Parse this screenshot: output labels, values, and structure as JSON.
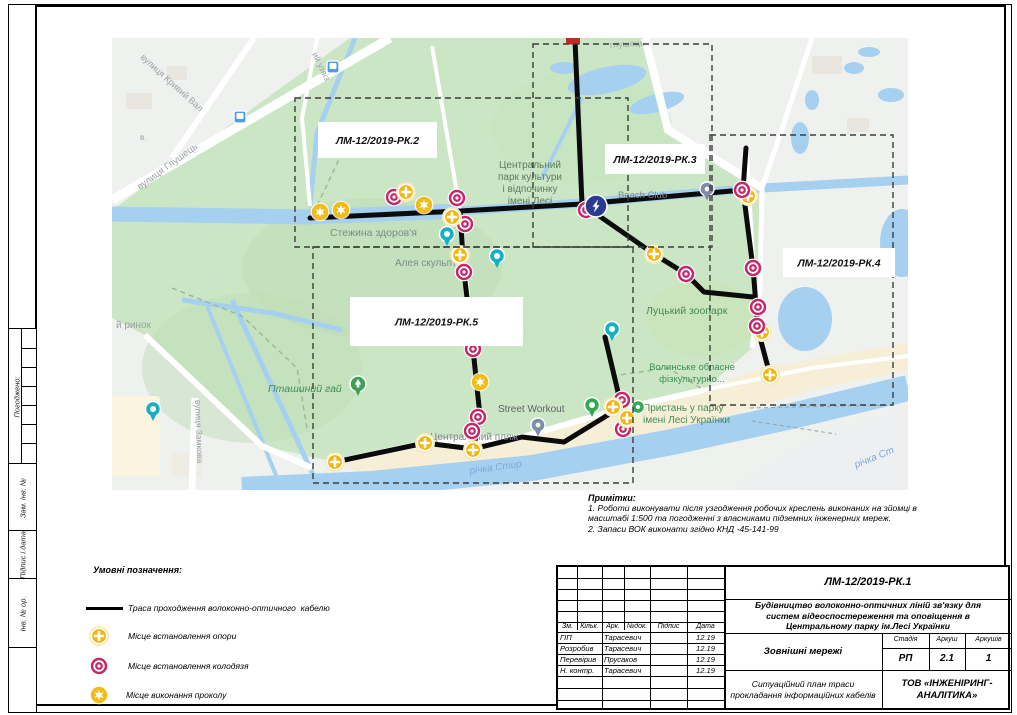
{
  "sidebar": {
    "sections": [
      "Погоджено:",
      "Зам. інв. №",
      "Підпис і дата",
      "Інв. № ор."
    ]
  },
  "legend": {
    "title": "Умовні позначення:",
    "items": [
      {
        "icon": "route-line",
        "label": "Траса проходження волоконно-оптичного  кабелю"
      },
      {
        "icon": "pole",
        "label": "Місце встановлення опори"
      },
      {
        "icon": "well",
        "label": "Місце встановлення колодязя"
      },
      {
        "icon": "puncture",
        "label": "Місце виконання проколу"
      }
    ]
  },
  "notes": {
    "title": "Примітки:",
    "lines": [
      "1. Роботи виконувати після узгодження робочих креслень виконаних на зйомці в",
      "масштабі 1:500 та погодженні з власниками підземних інженерних мереж.",
      "2. Запаси ВОК виконати згідно КНД -45-141-99"
    ]
  },
  "title_block": {
    "doc_code": "ЛМ-12/2019-РК.1",
    "project_title_lines": [
      "Будівництво волоконно-оптичних ліній зв'язку для",
      "систем відеоспостереження та оповіщення в",
      "Центральному парку ім.Лесі Українки"
    ],
    "section_title": "Зовнішні мережі",
    "drawing_title_lines": [
      "Ситуаційний план траси",
      "прокладання інформаційних кабелів"
    ],
    "company_lines": [
      "ТОВ «ІНЖЕНІРИНГ-",
      "АНАЛІТИКА»"
    ],
    "header_cols": [
      "Зм.",
      "Кільк.",
      "Арк.",
      "№док.",
      "Підпис",
      "Дата"
    ],
    "stage_header": [
      "Стадія",
      "Аркуш",
      "Аркушів"
    ],
    "stage_values": [
      "РП",
      "2.1",
      "1"
    ],
    "rows": [
      {
        "role": "ГІП",
        "name": "Тарасевич",
        "date": "12.19"
      },
      {
        "role": "Розробив",
        "name": "Тарасевич",
        "date": "12.19"
      },
      {
        "role": "Перевірив",
        "name": "Прусаков",
        "date": "12.19"
      },
      {
        "role": "Н. контр.",
        "name": "Тарасевич",
        "date": "12.19"
      }
    ]
  },
  "map": {
    "zones": [
      {
        "x": 183,
        "y": 60,
        "w": 333,
        "h": 149,
        "box": {
          "x": 206,
          "y": 84,
          "w": 119,
          "h": 36
        },
        "label": "ЛМ-12/2019-РК.2"
      },
      {
        "x": 421,
        "y": 6,
        "w": 179,
        "h": 203,
        "box": {
          "x": 493,
          "y": 106,
          "w": 100,
          "h": 30
        },
        "label": "ЛМ-12/2019-РК.3"
      },
      {
        "x": 598,
        "y": 97,
        "w": 183,
        "h": 270,
        "box": {
          "x": 671,
          "y": 210,
          "w": 112,
          "h": 29
        },
        "label": "ЛМ-12/2019-РК.4"
      },
      {
        "x": 201,
        "y": 209,
        "w": 320,
        "h": 236,
        "box": {
          "x": 238,
          "y": 259,
          "w": 173,
          "h": 49
        },
        "label": "ЛМ-12/2019-РК.5"
      }
    ],
    "routes": [
      {
        "points": [
          [
            463,
            2
          ],
          [
            470,
            166
          ]
        ]
      },
      {
        "points": [
          [
            198,
            180
          ],
          [
            348,
            173
          ],
          [
            470,
            166
          ],
          [
            631,
            152
          ]
        ]
      },
      {
        "points": [
          [
            470,
            166
          ],
          [
            542,
            216
          ]
        ]
      },
      {
        "points": [
          [
            542,
            216
          ],
          [
            574,
            236
          ],
          [
            592,
            254
          ],
          [
            641,
            259
          ]
        ]
      },
      {
        "points": [
          [
            634,
            110
          ],
          [
            631,
            152
          ],
          [
            641,
            230
          ],
          [
            646,
            292
          ],
          [
            658,
            337
          ]
        ]
      },
      {
        "points": [
          [
            348,
            173
          ],
          [
            352,
            234
          ],
          [
            361,
            311
          ],
          [
            368,
            378
          ],
          [
            362,
            408
          ]
        ]
      },
      {
        "points": [
          [
            223,
            424
          ],
          [
            313,
            405
          ],
          [
            361,
            411
          ],
          [
            410,
            399
          ],
          [
            452,
            404
          ],
          [
            504,
            372
          ]
        ]
      },
      {
        "points": [
          [
            493,
            299
          ],
          [
            506,
            354
          ],
          [
            504,
            372
          ]
        ]
      }
    ],
    "markers": [
      {
        "type": "well",
        "x": 282,
        "y": 159
      },
      {
        "type": "pole",
        "x": 294,
        "y": 154
      },
      {
        "type": "star",
        "x": 312,
        "y": 167
      },
      {
        "type": "star",
        "x": 208,
        "y": 174
      },
      {
        "type": "star",
        "x": 229,
        "y": 172
      },
      {
        "type": "well",
        "x": 345,
        "y": 160
      },
      {
        "type": "well",
        "x": 353,
        "y": 186
      },
      {
        "type": "pole",
        "x": 340,
        "y": 179
      },
      {
        "type": "teal",
        "x": 335,
        "y": 198
      },
      {
        "type": "teal",
        "x": 385,
        "y": 220
      },
      {
        "type": "pole",
        "x": 348,
        "y": 217
      },
      {
        "type": "well",
        "x": 352,
        "y": 234
      },
      {
        "type": "well",
        "x": 474,
        "y": 172
      },
      {
        "type": "junction",
        "x": 484,
        "y": 168
      },
      {
        "type": "pole",
        "x": 542,
        "y": 216
      },
      {
        "type": "well",
        "x": 574,
        "y": 236
      },
      {
        "type": "pole",
        "x": 636,
        "y": 158
      },
      {
        "type": "well",
        "x": 630,
        "y": 152
      },
      {
        "type": "well",
        "x": 641,
        "y": 230
      },
      {
        "type": "well",
        "x": 646,
        "y": 269
      },
      {
        "type": "pole",
        "x": 650,
        "y": 294
      },
      {
        "type": "well",
        "x": 645,
        "y": 288
      },
      {
        "type": "pole",
        "x": 658,
        "y": 337
      },
      {
        "type": "well",
        "x": 361,
        "y": 311
      },
      {
        "type": "star",
        "x": 368,
        "y": 344
      },
      {
        "type": "well",
        "x": 366,
        "y": 379
      },
      {
        "type": "well",
        "x": 360,
        "y": 393
      },
      {
        "type": "pole",
        "x": 313,
        "y": 405
      },
      {
        "type": "pole",
        "x": 223,
        "y": 424
      },
      {
        "type": "pole",
        "x": 361,
        "y": 412
      },
      {
        "type": "green-pin",
        "x": 480,
        "y": 369
      },
      {
        "type": "well",
        "x": 510,
        "y": 362
      },
      {
        "type": "pole",
        "x": 501,
        "y": 369
      },
      {
        "type": "well",
        "x": 511,
        "y": 391
      },
      {
        "type": "pole",
        "x": 515,
        "y": 380
      },
      {
        "type": "green-dot",
        "x": 526,
        "y": 369
      },
      {
        "type": "tree",
        "x": 246,
        "y": 348
      },
      {
        "type": "grey-pin",
        "x": 595,
        "y": 153
      },
      {
        "type": "grey-pin",
        "x": 426,
        "y": 389
      },
      {
        "type": "teal",
        "x": 403,
        "y": 293
      },
      {
        "type": "teal",
        "x": 500,
        "y": 293
      },
      {
        "type": "teal",
        "x": 41,
        "y": 373
      },
      {
        "type": "bus",
        "x": 128,
        "y": 79
      },
      {
        "type": "bus",
        "x": 221,
        "y": 29
      },
      {
        "type": "red-box",
        "x": 461,
        "y": 3
      }
    ],
    "labels": [
      {
        "t": "вулиця Кривий Вал",
        "x": 28,
        "y": 20,
        "r": 42,
        "c": "#9aa0a6",
        "s": 9
      },
      {
        "t": "ий узвіз",
        "x": 200,
        "y": 16,
        "r": 64,
        "c": "#9aa0a6",
        "s": 8.5
      },
      {
        "t": "вулиця Глушець",
        "x": 28,
        "y": 152,
        "r": -36,
        "c": "#9aa0a6",
        "s": 9.5
      },
      {
        "t": "вулиця Замкова",
        "x": 83,
        "y": 362,
        "r": 88,
        "c": "#9aa0a6",
        "s": 8.5
      },
      {
        "t": "й ринок",
        "x": 4,
        "y": 290,
        "r": 0,
        "c": "#9aa0a6",
        "s": 10
      },
      {
        "t": "в.",
        "x": 28,
        "y": 102,
        "r": 0,
        "c": "#9aa0a6",
        "s": 8
      },
      {
        "t": "глушець",
        "x": 498,
        "y": 10,
        "r": -4,
        "c": "#a5a8ab",
        "s": 9
      },
      {
        "t": "Центральний",
        "x": 418,
        "y": 130,
        "r": 0,
        "c": "#5e7a62",
        "s": 10,
        "a": "middle"
      },
      {
        "t": "парк культури",
        "x": 418,
        "y": 142,
        "r": 0,
        "c": "#5e7a62",
        "s": 10,
        "a": "middle"
      },
      {
        "t": "і відпочинку",
        "x": 418,
        "y": 154,
        "r": 0,
        "c": "#5e7a62",
        "s": 10,
        "a": "middle"
      },
      {
        "t": "імені Лесі",
        "x": 418,
        "y": 166,
        "r": 0,
        "c": "#5e7a62",
        "s": 10,
        "a": "middle"
      },
      {
        "t": "Стежина здоров'я",
        "x": 218,
        "y": 198,
        "r": 0,
        "c": "#7d8a8d",
        "s": 10.5
      },
      {
        "t": "Алея скульптур",
        "x": 283,
        "y": 228,
        "r": 0,
        "c": "#7d8a8d",
        "s": 10
      },
      {
        "t": "Пташиний гай",
        "x": 156,
        "y": 354,
        "r": 0,
        "c": "#3e8e54",
        "s": 10.5,
        "i": true
      },
      {
        "t": "Street Workout",
        "x": 386,
        "y": 374,
        "r": 0,
        "c": "#5f6368",
        "s": 10
      },
      {
        "t": "Луцький зоопарк",
        "x": 534,
        "y": 276,
        "r": 0,
        "c": "#3e8e54",
        "s": 10.5
      },
      {
        "t": "Волинське обласне",
        "x": 580,
        "y": 332,
        "r": 0,
        "c": "#3e8e54",
        "s": 9.5,
        "a": "middle"
      },
      {
        "t": "фізкультурно...",
        "x": 580,
        "y": 344,
        "r": 0,
        "c": "#3e8e54",
        "s": 9.5,
        "a": "middle"
      },
      {
        "t": "Пристань у парку",
        "x": 531,
        "y": 373,
        "r": 0,
        "c": "#3e8e54",
        "s": 10
      },
      {
        "t": "імені Лесі Українки",
        "x": 531,
        "y": 385,
        "r": 0,
        "c": "#3e8e54",
        "s": 10
      },
      {
        "t": "Центральний пляж",
        "x": 318,
        "y": 402,
        "r": 0,
        "c": "#80868b",
        "s": 10
      },
      {
        "t": "річка Стир",
        "x": 358,
        "y": 436,
        "r": -8,
        "c": "#7fa8d9",
        "s": 10,
        "i": true
      },
      {
        "t": "річка Ст",
        "x": 744,
        "y": 430,
        "r": -22,
        "c": "#7fa8d9",
        "s": 10,
        "i": true
      },
      {
        "t": "Beach Club",
        "x": 506,
        "y": 160,
        "r": 0,
        "c": "#80868b",
        "s": 9.5
      }
    ],
    "colors": {
      "route": "#0b0b0b",
      "pole": "#f3b510",
      "well": "#c5286a",
      "park": "#cbe6c4",
      "water": "#a6d0f0"
    }
  }
}
